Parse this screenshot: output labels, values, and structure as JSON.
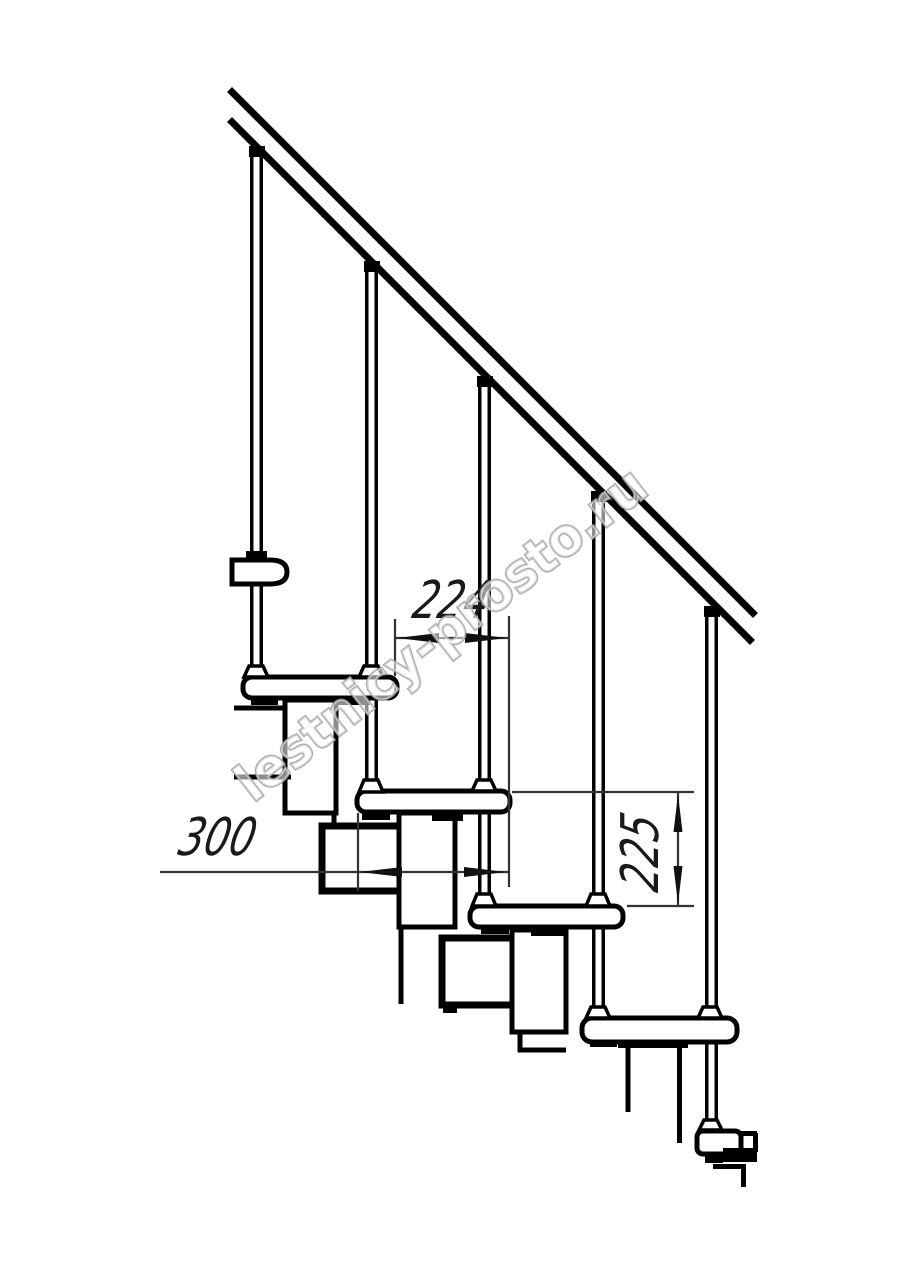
{
  "page": {
    "width": 914,
    "height": 1280,
    "background": "#ffffff"
  },
  "drawing": {
    "kind": "modular-staircase-side-elevation",
    "watermark_text": "lestnicy-prosto.ru",
    "colors": {
      "line": "#000000",
      "dimension": "#333333",
      "watermark_fill": "#ffffff",
      "watermark_outline": "#9e9e9e"
    },
    "stats": {
      "treads": 4,
      "balusters": 5
    },
    "dimensions": [
      {
        "id": "tread-run",
        "value": "224",
        "orientation": "horizontal"
      },
      {
        "id": "tread-depth",
        "value": "300",
        "orientation": "horizontal"
      },
      {
        "id": "step-rise",
        "value": "225",
        "orientation": "vertical"
      }
    ]
  }
}
